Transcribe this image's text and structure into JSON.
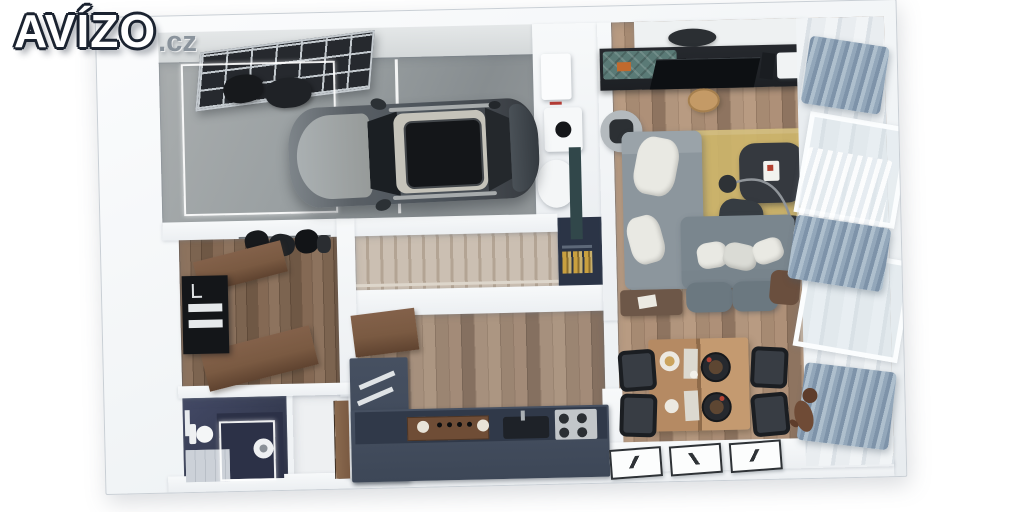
{
  "logo": {
    "text": "AVÍZO",
    "suffix": ".cz"
  },
  "palette": {
    "background": "#ffffff",
    "wall": "#f3f5f7",
    "wall_edge": "#c9cfd5",
    "garage_floor": "#9aa0a2",
    "garage_floor_dark": "#878d90",
    "garage_door": "#26292e",
    "garage_door_line": "#c4cacf",
    "car_body": "#4d545b",
    "car_hood": "#aab0b2",
    "car_roof": "#c5c3ba",
    "car_glass": "#1b1f23",
    "wood_light": "#b89b82",
    "wood_mid": "#a68a72",
    "wood_dark": "#8e7460",
    "hall_wood": "#7c6450",
    "hall_wood_light": "#8d735e",
    "stair_light": "#cbbfb2",
    "stair_dark": "#b3a494",
    "navy": "#363c52",
    "navy_dark": "#2b3044",
    "counter": "#3d4757",
    "counter_top": "#303949",
    "counter_wood": "#6f4d36",
    "nook": "#2b3446",
    "book_gold": "#c9a03f",
    "sofa": "#8c969d",
    "sofa_dark": "#7a868e",
    "pillow": "#e9e9e3",
    "rug": "#cdb56b",
    "table_dark": "#35393f",
    "teal": "#5a7a76",
    "orange": "#c06a2e",
    "curtain": "#7e93a9",
    "curtain_light": "#aebfcd",
    "dining_wood": "#b58a63",
    "chair": "#26292e",
    "bench_brown": "#6d5748",
    "pouf": "#6b7880",
    "dog": "#6f4b36",
    "frame_border": "#2e3236",
    "door_wood": "#7a5a42",
    "stool_wood": "#c49a66",
    "logo_fill": "#ffffff",
    "logo_outline": "#1b2330",
    "logo_suffix": "#8a939c"
  }
}
